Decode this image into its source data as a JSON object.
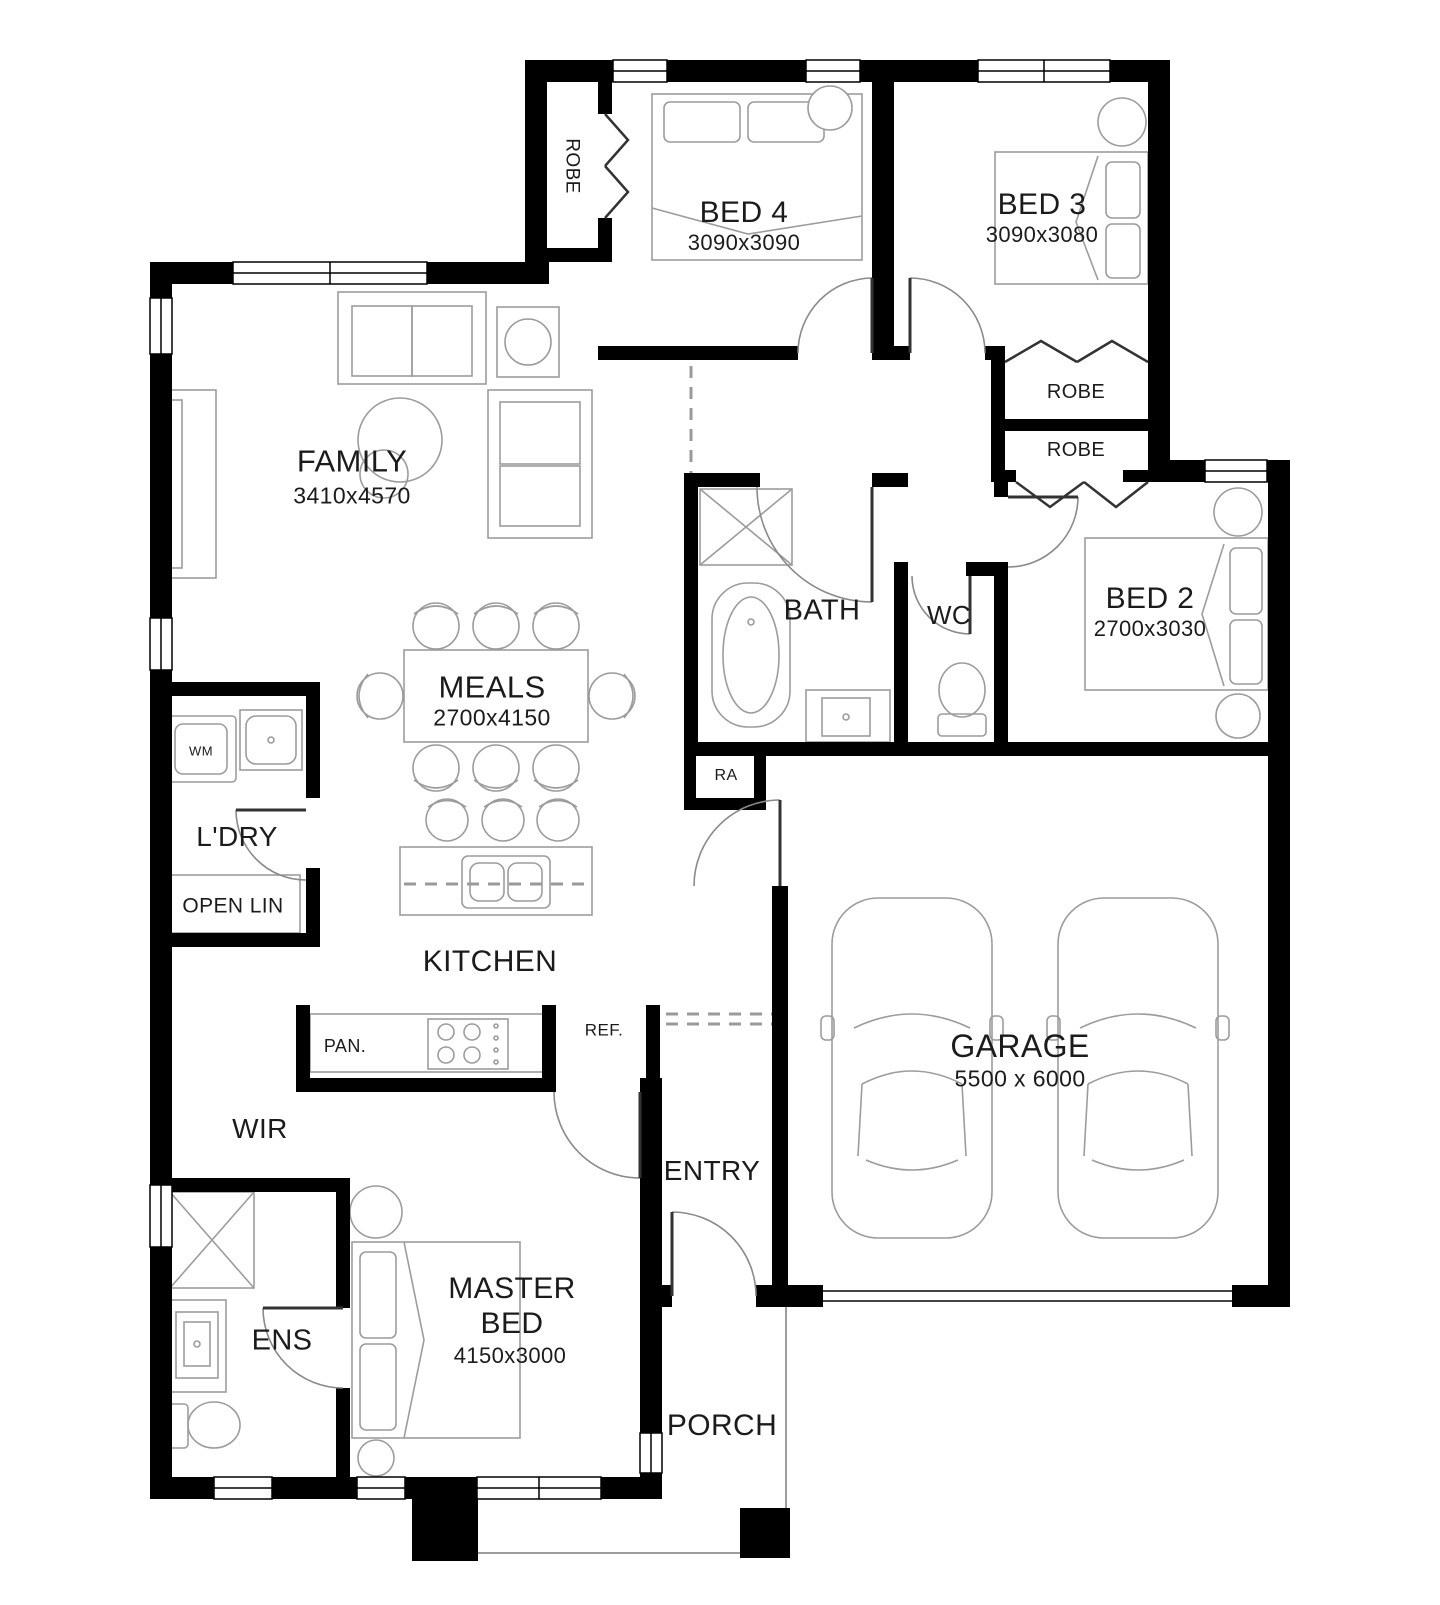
{
  "plan": {
    "colors": {
      "wall": "#000000",
      "furniture_line": "#9c9c9c",
      "door_line": "#888888",
      "text": "#1b1b1b",
      "background": "#ffffff"
    },
    "rooms": {
      "family": {
        "name": "FAMILY",
        "dims": "3410x4570"
      },
      "meals": {
        "name": "MEALS",
        "dims": "2700x4150"
      },
      "kitchen": {
        "name": "KITCHEN"
      },
      "bed4": {
        "name": "BED 4",
        "dims": "3090x3090"
      },
      "bed3": {
        "name": "BED 3",
        "dims": "3090x3080"
      },
      "bed2": {
        "name": "BED 2",
        "dims": "2700x3030"
      },
      "master": {
        "name_line1": "MASTER",
        "name_line2": "BED",
        "dims": "4150x3000"
      },
      "garage": {
        "name": "GARAGE",
        "dims": "5500 x 6000"
      },
      "bath": {
        "name": "BATH"
      },
      "wc": {
        "name": "WC"
      },
      "ens": {
        "name": "ENS"
      },
      "wir": {
        "name": "WIR"
      },
      "ldry": {
        "name": "L'DRY"
      },
      "entry": {
        "name": "ENTRY"
      },
      "porch": {
        "name": "PORCH"
      },
      "robe_bed4": {
        "name": "ROBE"
      },
      "robe_bed3": {
        "name": "ROBE"
      },
      "robe_bed2": {
        "name": "ROBE"
      },
      "open_lin": {
        "name": "OPEN LIN"
      },
      "ra": {
        "name": "RA"
      },
      "wm": {
        "name": "WM"
      },
      "pan": {
        "name": "PAN."
      },
      "ref": {
        "name": "REF."
      }
    }
  }
}
